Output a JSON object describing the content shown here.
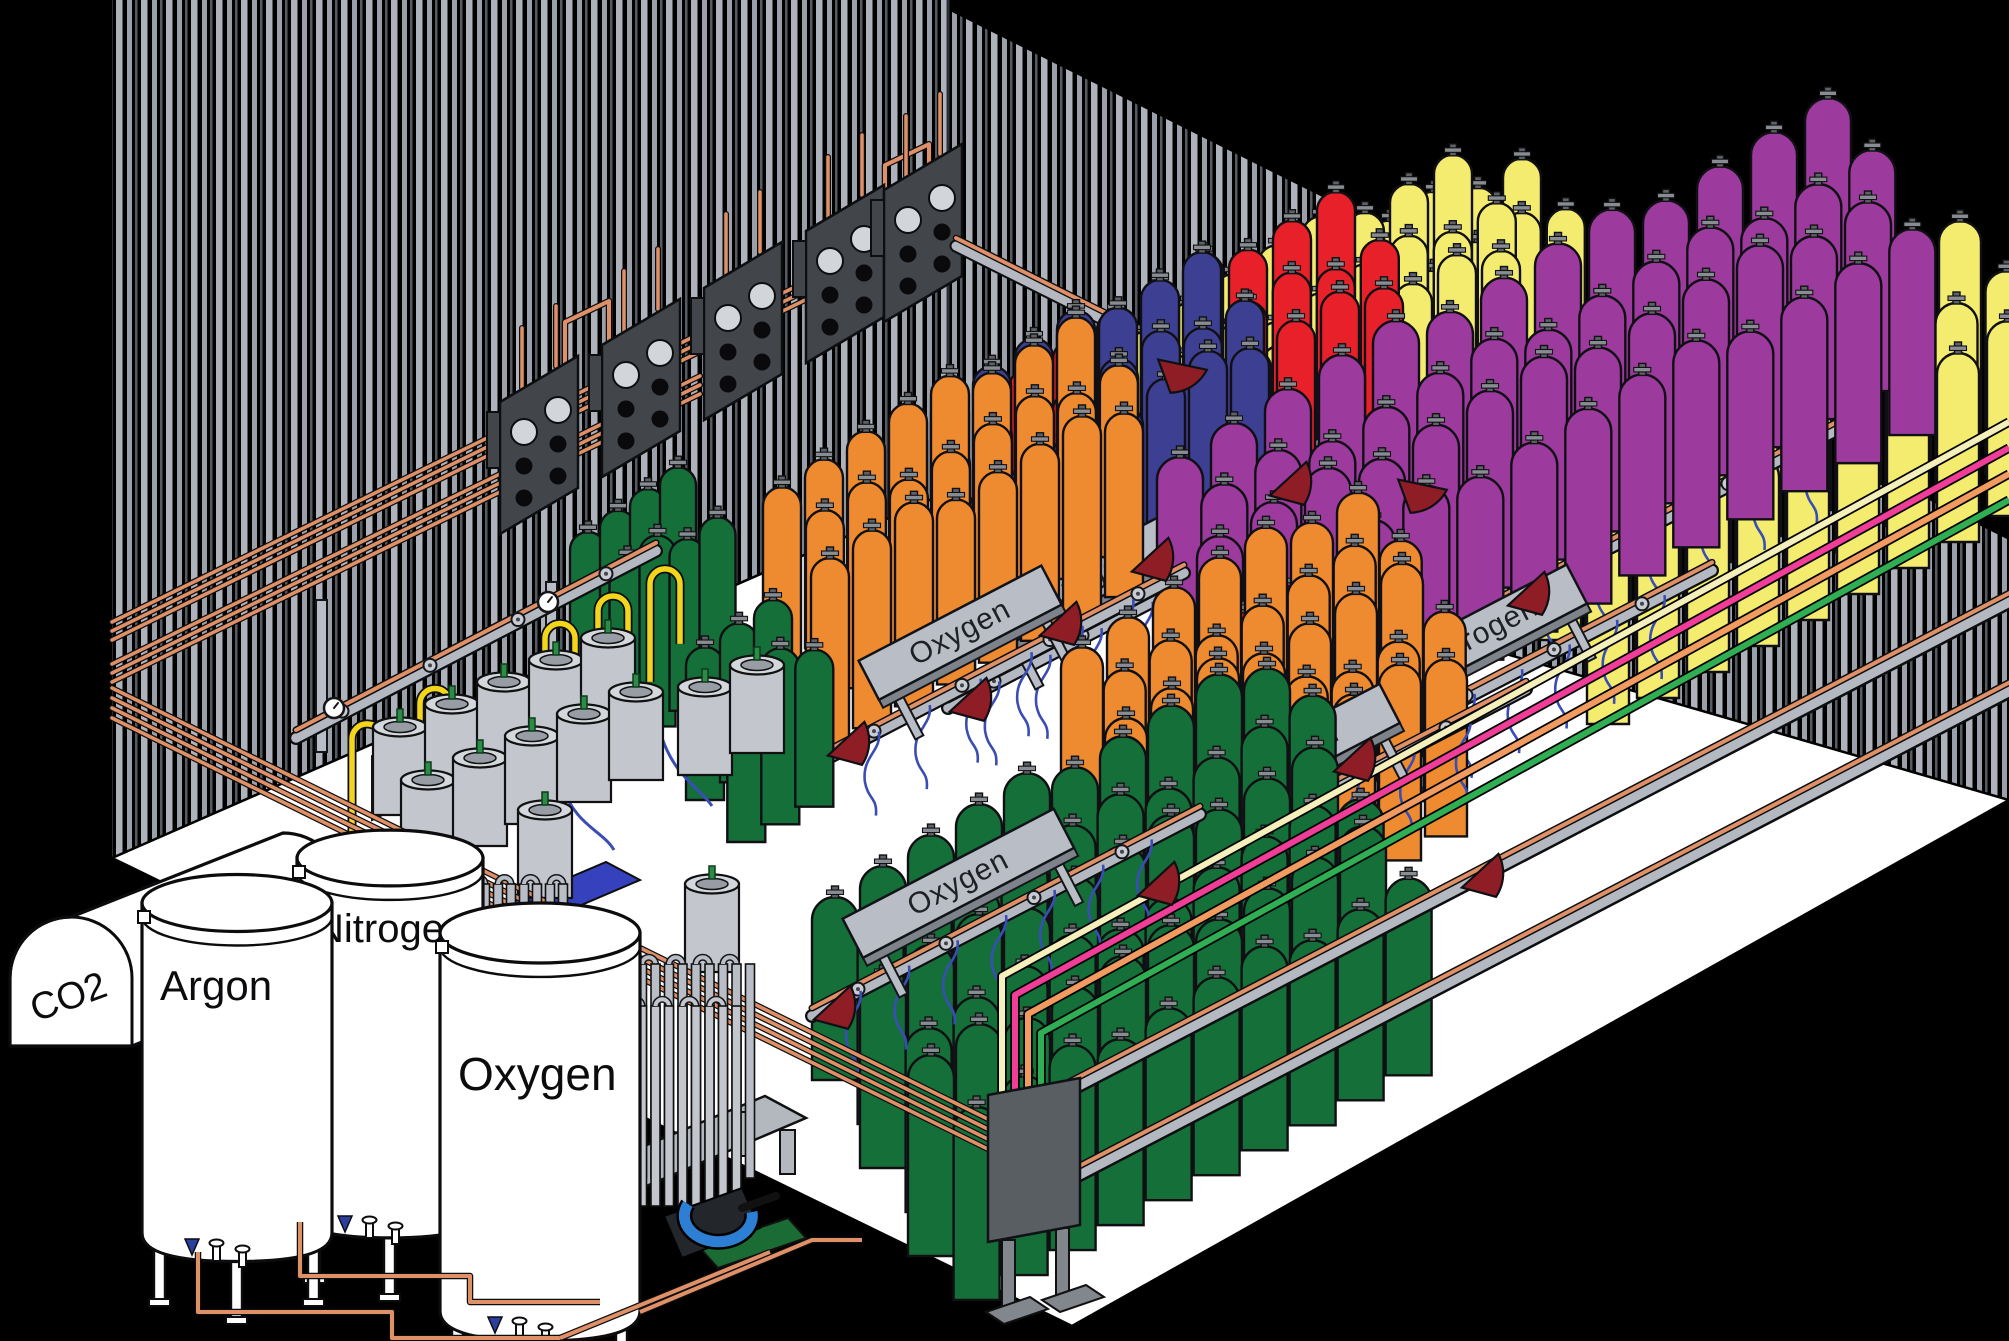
{
  "scene": {
    "title": "Industrial gas cylinder filling plant - isometric cutaway",
    "background": "#000000",
    "floor_color": "#ffffff",
    "wall": {
      "stripe_light": "#9aa0a9",
      "stripe_dim": "#565c64",
      "stripe_bright": "#aeb3bb"
    },
    "colors": {
      "orange": "#ee8a2f",
      "blue": "#3d3f93",
      "red": "#e8202a",
      "yellow": "#f3ec6f",
      "purple": "#9c3a9e",
      "green": "#156f39",
      "copper": "#e09066",
      "dark_red": "#8f1d26",
      "hose_blue": "#3a4db5",
      "panel_dark": "#42464b",
      "yellow_pipe": "#f3d51c",
      "pallet_blue": "#3642bd",
      "pump_blue": "#2d7fd3",
      "pump_green": "#1b6b35",
      "dewar_gray": "#c3c7cd",
      "sign_gray": "#b9bdc5",
      "rail_gray": "#b4b8c0"
    },
    "racks": [
      {
        "label": "Argon",
        "color": "yellow",
        "anchor": [
          1258,
          470
        ],
        "rows": 2,
        "rowOff": [
          24,
          42
        ],
        "n": 7,
        "sp": 44,
        "w": 38,
        "h": 175,
        "sign": [
          1318,
          432,
          190
        ],
        "fs": 30,
        "hoses": 5
      },
      {
        "label": "Carbon Dioxide",
        "color": "yellow",
        "anchor": [
          1145,
          505
        ],
        "rows": 3,
        "rowOff": [
          24,
          40
        ],
        "n": 8,
        "sp": 44,
        "w": 38,
        "h": 185,
        "sign": [
          1180,
          508,
          252
        ],
        "fs": 26,
        "hoses": 6
      },
      {
        "label": "Helium",
        "color": "red",
        "anchor": [
          1028,
          535
        ],
        "rows": 3,
        "rowOff": [
          24,
          40
        ],
        "n": 8,
        "sp": 44,
        "w": 38,
        "h": 178,
        "sign": [
          1088,
          572,
          196
        ],
        "fs": 30,
        "hoses": 6
      },
      {
        "label": "Argon",
        "color": "yellow",
        "anchor": [
          1560,
          640
        ],
        "rows": 3,
        "rowOff": [
          24,
          42
        ],
        "n": 9,
        "sp": 50,
        "w": 42,
        "h": 200,
        "sign": [
          1556,
          542,
          216
        ],
        "fs": 30,
        "hoses": 6
      },
      {
        "label": "Nitrogen",
        "color": "blue",
        "anchor": [
          908,
          600
        ],
        "rows": 3,
        "rowOff": [
          24,
          40
        ],
        "n": 8,
        "sp": 42,
        "w": 38,
        "h": 190,
        "sign": [
          998,
          648,
          208
        ],
        "fs": 30,
        "hoses": 6
      },
      {
        "label": "Hydrogen",
        "color": "purple",
        "anchor": [
          1180,
          640
        ],
        "rows": 4,
        "rowOff": [
          20,
          44
        ],
        "n": 13,
        "sp": 54,
        "w": 46,
        "h": 195,
        "sign": [
          1382,
          708,
          230
        ],
        "fs": 30,
        "hoses": 7
      },
      {
        "label": "Oxygen",
        "color": "orange",
        "anchor": [
          782,
          670
        ],
        "rows": 3,
        "rowOff": [
          24,
          40
        ],
        "n": 8,
        "sp": 42,
        "w": 38,
        "h": 195,
        "sign": [
          878,
          698,
          206
        ],
        "fs": 30,
        "hoses": 6
      },
      {
        "label": "",
        "color": "green",
        "anchor": [
          588,
          700
        ],
        "rows": 2,
        "rowOff": [
          26,
          42
        ],
        "n": 4,
        "sp": 30,
        "w": 36,
        "h": 180
      },
      {
        "label": "",
        "color": "red",
        "anchor": [
          1242,
          750
        ],
        "rows": 1,
        "rowOff": [
          24,
          36
        ],
        "n": 2,
        "sp": 40,
        "w": 36,
        "h": 150
      },
      {
        "label": "Nitrogen",
        "color": "orange",
        "anchor": [
          1082,
          820
        ],
        "rows": 5,
        "rowOff": [
          22,
          40
        ],
        "n": 7,
        "sp": 46,
        "w": 42,
        "h": 185,
        "sign": [
          1186,
          832,
          240
        ],
        "fs": 30,
        "hoses": 6
      },
      {
        "label": "",
        "color": "green",
        "anchor": [
          705,
          800
        ],
        "rows": 2,
        "rowOff": [
          26,
          42
        ],
        "n": 3,
        "sp": 34,
        "w": 38,
        "h": 165
      },
      {
        "label": "Oxygen",
        "color": "green",
        "anchor": [
          835,
          1080
        ],
        "rows": 6,
        "rowOff": [
          24,
          44
        ],
        "n": 10,
        "sp": 48,
        "w": 46,
        "h": 195,
        "sign": [
          862,
          956,
          238
        ],
        "fs": 30,
        "hoses": 7
      }
    ],
    "tanks": [
      {
        "label": "CO2",
        "type": "horizontal"
      },
      {
        "label": "Nitrogen",
        "cx": 390,
        "top": 858,
        "rx": 93,
        "h": 352,
        "label_y": 942,
        "fs": 40
      },
      {
        "label": "Argon",
        "cx": 237,
        "top": 903,
        "rx": 95,
        "h": 330,
        "label_y": 1000,
        "fs": 42
      },
      {
        "label": "Oxygen",
        "cx": 540,
        "top": 933,
        "rx": 100,
        "h": 378,
        "label_y": 1090,
        "fs": 46
      }
    ],
    "supply_lines": [
      {
        "name": "cream",
        "color": "#f5efbc"
      },
      {
        "name": "pink",
        "color": "#ef3d98"
      },
      {
        "name": "salmon",
        "color": "#f29b61"
      },
      {
        "name": "green",
        "color": "#2fae53"
      }
    ],
    "funnels": [
      [
        826,
        752
      ],
      [
        948,
        708
      ],
      [
        1038,
        632
      ],
      [
        1130,
        568
      ],
      [
        1268,
        492
      ],
      [
        1506,
        602
      ],
      [
        1332,
        768
      ],
      [
        1136,
        892
      ],
      [
        812,
        1016
      ],
      [
        1460,
        884
      ],
      [
        1160,
        356,
        27
      ],
      [
        1400,
        476,
        27
      ]
    ],
    "panels": [
      [
        500,
        402
      ],
      [
        602,
        345
      ],
      [
        704,
        288
      ],
      [
        806,
        231
      ],
      [
        884,
        190
      ]
    ],
    "dewars": [
      [
        400,
        815
      ],
      [
        452,
        792
      ],
      [
        504,
        770
      ],
      [
        556,
        748
      ],
      [
        608,
        726
      ],
      [
        428,
        868
      ],
      [
        480,
        846
      ],
      [
        532,
        824
      ],
      [
        584,
        802
      ],
      [
        636,
        780
      ],
      [
        705,
        775
      ],
      [
        757,
        753
      ],
      [
        545,
        898
      ],
      [
        712,
        972
      ]
    ]
  }
}
